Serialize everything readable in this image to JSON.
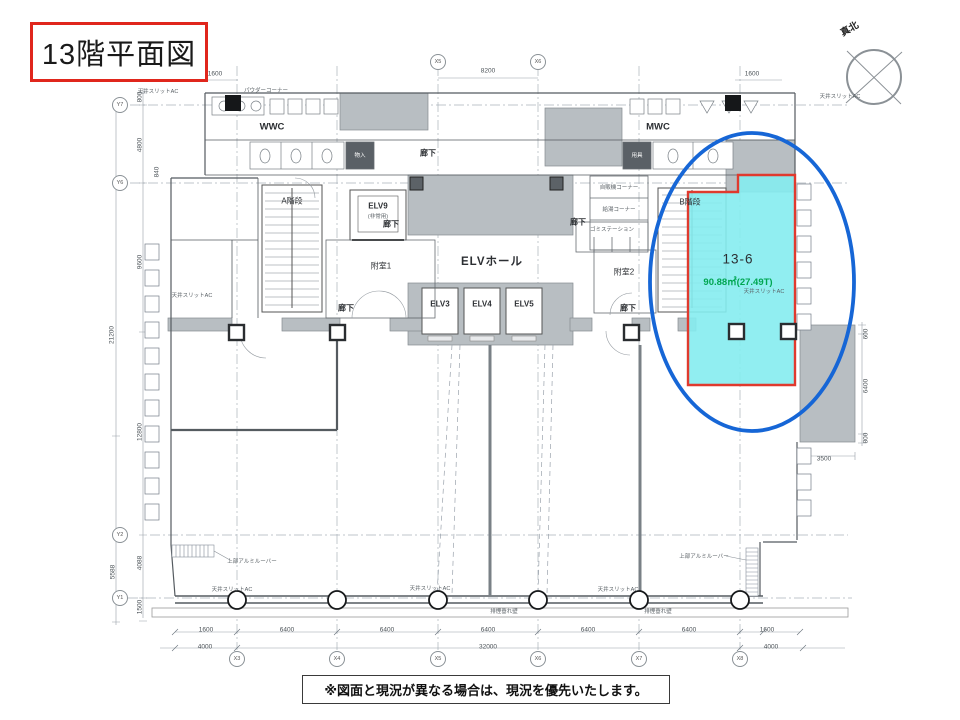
{
  "title": "13階平面図",
  "compass": {
    "label": "真北"
  },
  "note": "※図面と現況が異なる場合は、現況を優先いたします。",
  "colors": {
    "highlight_fill": "#85ECEF",
    "highlight_border": "#E03A2E",
    "ellipse_stroke": "#1666D6",
    "area_text": "#00A651",
    "title_border": "#E0261C"
  },
  "highlight": {
    "room_no": "13-6",
    "area": "90.88㎡(27.49T)"
  },
  "rooms": {
    "a_stair": "A階段",
    "elv9": "ELV9",
    "elv9_sub": "(非常用)",
    "fushitsu1": "附室1",
    "elv_hall": "ELVホール",
    "elv3": "ELV3",
    "elv4": "ELV4",
    "elv5": "ELV5",
    "fushitsu2": "附室2",
    "b_stair": "B階段",
    "wwc": "WWC",
    "mwc": "MWC",
    "powder": "パウダーコーナー",
    "monoire": "物入",
    "yogu": "用具",
    "vending": "自販機コーナー",
    "kyuto": "給湯コーナー",
    "gomi": "ゴミステーション",
    "corridor": "廊下",
    "louver": "上部アルミルーバー"
  },
  "corridor_positions": [
    {
      "x": 428,
      "y": 153
    },
    {
      "x": 391,
      "y": 224
    },
    {
      "x": 578,
      "y": 222
    },
    {
      "x": 346,
      "y": 308
    },
    {
      "x": 628,
      "y": 308
    }
  ],
  "dims": {
    "top": [
      {
        "t": "1600",
        "x": 215,
        "y": 74
      },
      {
        "t": "8200",
        "x": 488,
        "y": 71
      },
      {
        "t": "1600",
        "x": 752,
        "y": 74
      }
    ],
    "left": [
      {
        "t": "800",
        "x": 140,
        "y": 97,
        "v": 1
      },
      {
        "t": "4800",
        "x": 140,
        "y": 145,
        "v": 1
      },
      {
        "t": "840",
        "x": 157,
        "y": 172,
        "v": 1
      },
      {
        "t": "9600",
        "x": 140,
        "y": 262,
        "v": 1
      },
      {
        "t": "21200",
        "x": 112,
        "y": 335,
        "v": 1
      },
      {
        "t": "12800",
        "x": 140,
        "y": 432,
        "v": 1
      },
      {
        "t": "4088",
        "x": 140,
        "y": 563,
        "v": 1
      },
      {
        "t": "5588",
        "x": 113,
        "y": 572,
        "v": 1
      },
      {
        "t": "1500",
        "x": 140,
        "y": 607,
        "v": 1
      }
    ],
    "right": [
      {
        "t": "600",
        "x": 866,
        "y": 334,
        "v": 1
      },
      {
        "t": "6400",
        "x": 866,
        "y": 386,
        "v": 1
      },
      {
        "t": "800",
        "x": 866,
        "y": 438,
        "v": 1
      },
      {
        "t": "3500",
        "x": 824,
        "y": 459
      }
    ],
    "bottom_segments": [
      {
        "t": "1600",
        "x": 206,
        "y": 630
      },
      {
        "t": "6400",
        "x": 287,
        "y": 630
      },
      {
        "t": "6400",
        "x": 387,
        "y": 630
      },
      {
        "t": "6400",
        "x": 488,
        "y": 630
      },
      {
        "t": "6400",
        "x": 588,
        "y": 630
      },
      {
        "t": "6400",
        "x": 689,
        "y": 630
      },
      {
        "t": "1600",
        "x": 767,
        "y": 630
      }
    ],
    "bottom_overall": [
      {
        "t": "4000",
        "x": 205,
        "y": 647
      },
      {
        "t": "32000",
        "x": 488,
        "y": 647
      },
      {
        "t": "4000",
        "x": 771,
        "y": 647
      }
    ]
  },
  "grid": {
    "x_top": [
      {
        "label": "X5",
        "x": 438,
        "y": 62
      },
      {
        "label": "X6",
        "x": 538,
        "y": 62
      }
    ],
    "x_bottom": [
      {
        "label": "X3",
        "x": 237,
        "y": 659
      },
      {
        "label": "X4",
        "x": 337,
        "y": 659
      },
      {
        "label": "X5",
        "x": 438,
        "y": 659
      },
      {
        "label": "X6",
        "x": 538,
        "y": 659
      },
      {
        "label": "X7",
        "x": 639,
        "y": 659
      },
      {
        "label": "X8",
        "x": 740,
        "y": 659
      }
    ],
    "y_left": [
      {
        "label": "Y7",
        "x": 120,
        "y": 105
      },
      {
        "label": "Y6",
        "x": 120,
        "y": 183
      },
      {
        "label": "Y2",
        "x": 120,
        "y": 535
      },
      {
        "label": "Y1",
        "x": 120,
        "y": 598
      }
    ]
  },
  "annotations": [
    {
      "t": "天井スリットAC",
      "x": 158,
      "y": 91
    },
    {
      "t": "天井スリットAC",
      "x": 840,
      "y": 96
    },
    {
      "t": "天井スリットAC",
      "x": 192,
      "y": 295
    },
    {
      "t": "天井スリットAC",
      "x": 764,
      "y": 291
    },
    {
      "t": "天井スリットAC",
      "x": 232,
      "y": 589
    },
    {
      "t": "天井スリットAC",
      "x": 430,
      "y": 588
    },
    {
      "t": "天井スリットAC",
      "x": 618,
      "y": 589
    },
    {
      "t": "排煙垂れ壁",
      "x": 504,
      "y": 611
    },
    {
      "t": "排煙垂れ壁",
      "x": 658,
      "y": 611
    }
  ]
}
